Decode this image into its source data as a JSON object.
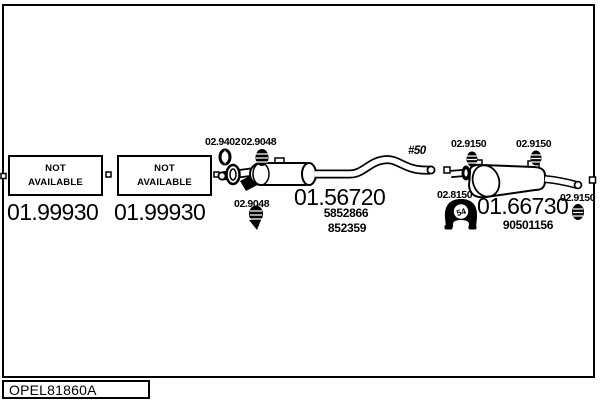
{
  "footer": {
    "code": "OPEL81860A"
  },
  "colors": {
    "line": "#000000",
    "background": "#ffffff",
    "text": "#000000"
  },
  "parts": {
    "front_left": [
      {
        "status": "NOT AVAILABLE",
        "part_number": "01.99930"
      },
      {
        "status": "NOT AVAILABLE",
        "part_number": "01.99930"
      }
    ],
    "center_muffler": {
      "part_number": "01.56720",
      "oe_refs": [
        "5852866",
        "852359"
      ],
      "clamp_front": "02.9402",
      "gasket": "02.9048",
      "clamp_rear": "02.9048",
      "pipe_diameter_note": "#50"
    },
    "rear_muffler": {
      "part_number": "01.66730",
      "oe_ref": "90501156",
      "hanger_front": "02.9150",
      "hanger_mid": "02.9150",
      "hanger_tail": "02.9150",
      "mount_bracket": "02.8150",
      "mount_badge": "54"
    }
  },
  "icons": {
    "ring_clamp": "ring-clamp-icon",
    "gasket": "gasket-icon",
    "clamp": "clamp-icon",
    "hanger": "rubber-hanger-icon",
    "bracket": "mount-bracket-icon"
  }
}
